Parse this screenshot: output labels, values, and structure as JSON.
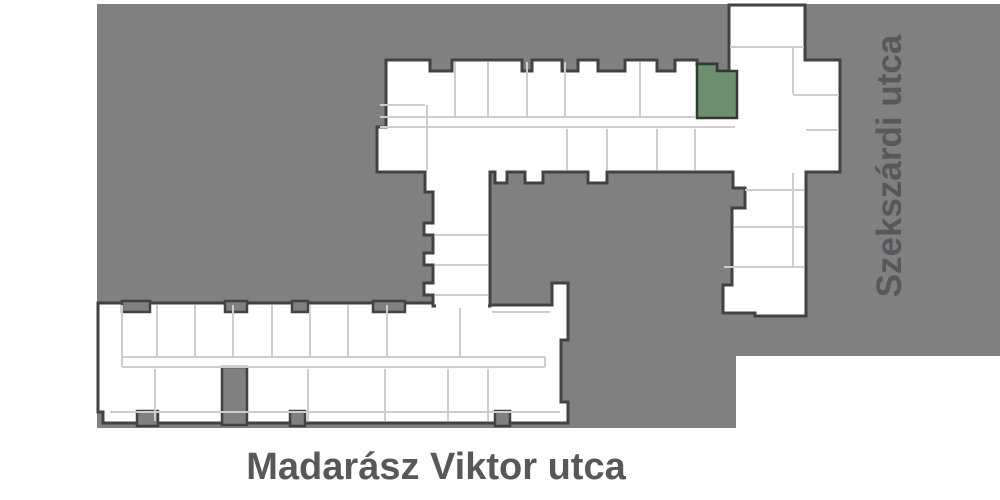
{
  "site_plan": {
    "streets": {
      "bottom": {
        "label": "Madarász Viktor utca"
      },
      "right": {
        "label": "Szekszárdi utca"
      }
    },
    "colors": {
      "site_area": "#808080",
      "building_outline": "#424242",
      "building_fill": "#ffffff",
      "partition_line": "#cdcdcd",
      "street_text": "#58585a",
      "selected_unit_fill": "#6d8f70",
      "selected_unit_stroke": "#2f3b30"
    }
  }
}
